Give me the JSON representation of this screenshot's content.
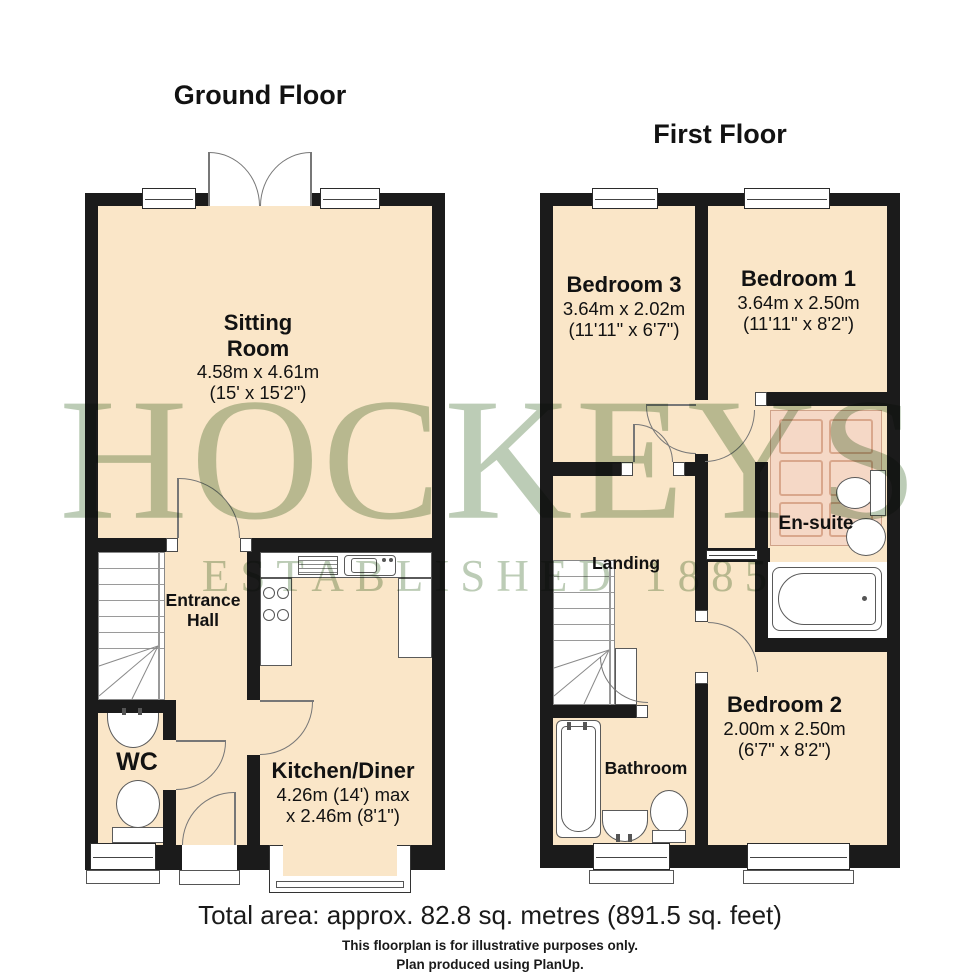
{
  "ground_floor": {
    "title": "Ground Floor",
    "rooms": {
      "sitting": {
        "line1": "Sitting",
        "line2": "Room",
        "metric": "4.58m x 4.61m",
        "imperial": "(15' x 15'2\")"
      },
      "entrance": {
        "line1": "Entrance",
        "line2": "Hall"
      },
      "wc": {
        "name": "WC"
      },
      "kitchen": {
        "name": "Kitchen/Diner",
        "metric": "4.26m (14') max",
        "imperial": "x 2.46m (8'1\")"
      }
    }
  },
  "first_floor": {
    "title": "First Floor",
    "rooms": {
      "bedroom3": {
        "name": "Bedroom 3",
        "metric": "3.64m x 2.02m",
        "imperial": "(11'11\" x 6'7\")"
      },
      "bedroom1": {
        "name": "Bedroom 1",
        "metric": "3.64m x 2.50m",
        "imperial": "(11'11\" x 8'2\")"
      },
      "ensuite": {
        "name": "En-suite"
      },
      "landing": {
        "name": "Landing"
      },
      "bathroom": {
        "name": "Bathroom"
      },
      "bedroom2": {
        "name": "Bedroom 2",
        "metric": "2.00m x 2.50m",
        "imperial": "(6'7\" x 8'2\")"
      }
    }
  },
  "watermark": {
    "brand": "HOCKEYS",
    "established": "ESTABLISHED 1885"
  },
  "footer": {
    "total_area": "Total area: approx. 82.8 sq. metres (891.5 sq. feet)",
    "disclaimer": "This floorplan is for illustrative purposes only.",
    "credit": "Plan produced using PlanUp."
  },
  "colors": {
    "room_fill": "#fae6c8",
    "wall": "#1b1b1b",
    "watermark_green": "#b9c9b2",
    "rug": "#f5d8c6"
  }
}
